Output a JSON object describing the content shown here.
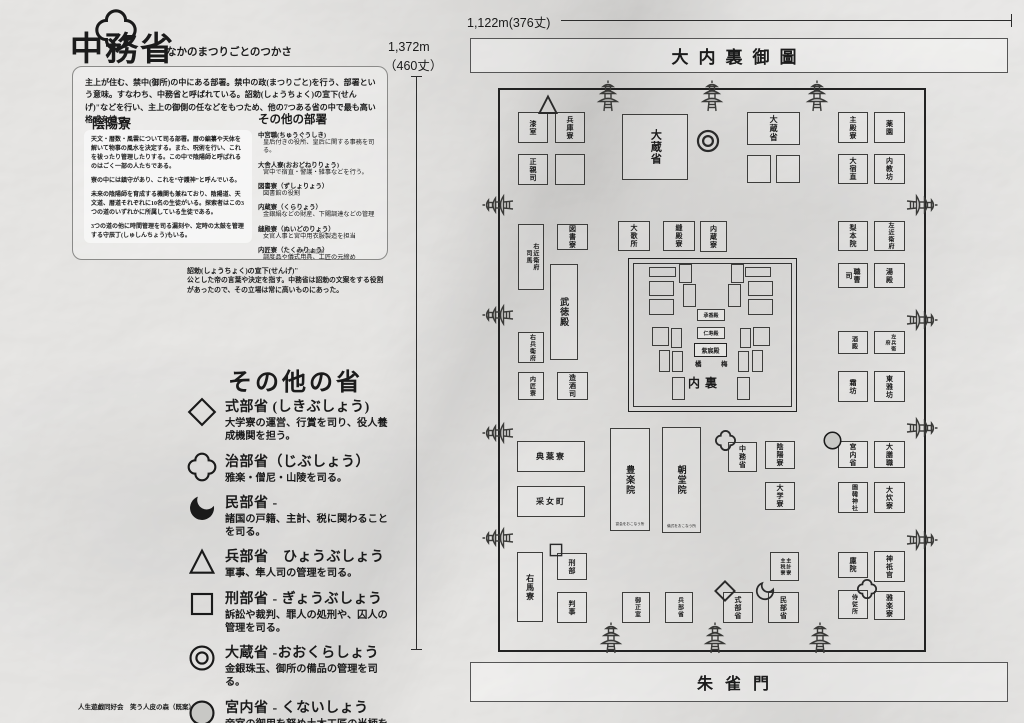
{
  "header": {
    "title": "中務省",
    "title_ruby": "なかのまつりごとのつかさ",
    "intro": "主上が住む、禁中(御所)の中にある部署。禁中の政(まつりごと)を行う、部署という意味。すなわち、中務省と呼ばれている。詔勅(しょうちょく)の宣下(せんげ)\"などを行い、主上の御側の任などをもつため、他の7つある省の中で最も高い格式を持つ。"
  },
  "onmyoryo": {
    "heading": "陰陽寮",
    "paragraphs": [
      "天文・暦数・風雲について司る部署。暦の編纂や天体を解いて物事の風水を決定する。また、呪術を行い、これを祓ったり管理したりする。この中で陰陽師と呼ばれるのはごく一部の人たちである。",
      "寮の中には鎮守があり、これを“守護神”と呼んでいる。",
      "未来の陰陽師を育成する機関も兼ねており、陰陽道、天文道、暦道それぞれに10名の生徒がいる。探索者はこの3つの道のいずれかに所属している生徒である。",
      "3つの道の他に時間管理を司る漏刻や、定時の太鼓を管理する守辰丁(しゅしんちょう)もいる。"
    ]
  },
  "other_departments": {
    "heading": "その他の部署",
    "items": [
      {
        "name": "中宮職(ちゅうぐうしき)",
        "desc": "皇后付きの役所、皇后に関する事務を司る。"
      },
      {
        "name": "大舎人寮(おおどねりりょう)",
        "desc": "宮中で宿直・警護・雑事などを行う。"
      },
      {
        "name": "図書寮（ずしょりょう）",
        "desc": "図書館の役割"
      },
      {
        "name": "内蔵寮（くらりょう）",
        "desc": "金銀絹などの財産、下賜調達などの管理"
      },
      {
        "name": "縫殿寮（ぬいどのりょう）",
        "desc": "女官人事と宮中用衣服製造を担当"
      },
      {
        "name": "内匠寮（たくみりょう）",
        "desc": "調度品や儀式用具、工匠の元締め"
      }
    ],
    "credit": "参考:官職図解"
  },
  "footnote": {
    "title": "詔勅(しょうちょく)の宣下(せんげ)\"",
    "body": "公とした帝の言葉や決定を指す。中務省は詔勅の文案をする役割があったので、その立場は常に高いものにあった。"
  },
  "legend": {
    "heading": "その他の省",
    "items": [
      {
        "symbol": "diamond",
        "name": "式部省 (しきぶしょう)",
        "desc": "大学寮の運営、行賞を司り、役人養成機関を担う。"
      },
      {
        "symbol": "clover",
        "name": "治部省（じぶしょう）",
        "desc": "雅楽・僧尼・山陵を司る。"
      },
      {
        "symbol": "crescent",
        "name": "民部省 -",
        "desc": "諸国の戸籍、主計、税に関わることを司る。"
      },
      {
        "symbol": "triangle",
        "name": "兵部省　ひょうぶしょう",
        "desc": "軍事、隼人司の管理を司る。"
      },
      {
        "symbol": "square",
        "name": "刑部省 - ぎょうぶしょう",
        "desc": "訴訟や裁判、罪人の処刑や、囚人の管理を司る。"
      },
      {
        "symbol": "dcircle",
        "name": "大蔵省 -おおくらしょう",
        "desc": "金銀珠玉、御所の備品の管理を司る。"
      },
      {
        "symbol": "circle",
        "name": "宮内省 - くないしょう",
        "desc": "帝室の御用を努め土木工匠の当柄を司る。"
      }
    ]
  },
  "rulers": {
    "top": "1,122m(376丈)",
    "left_line1": "1,372m",
    "left_line2": "（460丈）"
  },
  "map": {
    "title": "大内裏御圖",
    "south_gate": "朱雀門",
    "buildings": [
      {
        "x": 518,
        "y": 112,
        "w": 30,
        "h": 31,
        "label": "漆室"
      },
      {
        "x": 555,
        "y": 112,
        "w": 30,
        "h": 31,
        "label": "兵庫寮",
        "marker": "triangle",
        "mx": 536,
        "my": 93,
        "ms": 24
      },
      {
        "x": 518,
        "y": 154,
        "w": 30,
        "h": 31,
        "label": "正親司"
      },
      {
        "x": 555,
        "y": 154,
        "w": 30,
        "h": 31,
        "label": ""
      },
      {
        "x": 622,
        "y": 114,
        "w": 66,
        "h": 66,
        "label": "大蔵省",
        "fs": 11,
        "marker": "dcircle",
        "mx": 694,
        "my": 127,
        "ms": 28
      },
      {
        "x": 747,
        "y": 112,
        "w": 53,
        "h": 33,
        "label": "大蔵省",
        "fs": 8
      },
      {
        "x": 747,
        "y": 155,
        "w": 24,
        "h": 28,
        "label": ""
      },
      {
        "x": 776,
        "y": 155,
        "w": 24,
        "h": 28,
        "label": ""
      },
      {
        "x": 838,
        "y": 112,
        "w": 30,
        "h": 31,
        "label": "主殿寮"
      },
      {
        "x": 874,
        "y": 112,
        "w": 31,
        "h": 31,
        "label": "薬園"
      },
      {
        "x": 838,
        "y": 154,
        "w": 30,
        "h": 30,
        "label": "大宿直"
      },
      {
        "x": 874,
        "y": 154,
        "w": 31,
        "h": 30,
        "label": "内教坊"
      },
      {
        "x": 518,
        "y": 224,
        "w": 26,
        "h": 66,
        "label": "右近衛府",
        "label2": "司馬",
        "fs": 6
      },
      {
        "x": 557,
        "y": 224,
        "w": 31,
        "h": 26,
        "label": "図書寮"
      },
      {
        "x": 618,
        "y": 221,
        "w": 32,
        "h": 30,
        "label": "大歌所"
      },
      {
        "x": 663,
        "y": 221,
        "w": 32,
        "h": 30,
        "label": "縫殿寮"
      },
      {
        "x": 700,
        "y": 221,
        "w": 27,
        "h": 31,
        "label": "内蔵寮"
      },
      {
        "x": 838,
        "y": 221,
        "w": 30,
        "h": 30,
        "label": "梨本院"
      },
      {
        "x": 874,
        "y": 221,
        "w": 31,
        "h": 30,
        "label": "左近衛府",
        "fs": 6
      },
      {
        "x": 838,
        "y": 263,
        "w": 30,
        "h": 25,
        "label": "職曹司"
      },
      {
        "x": 874,
        "y": 263,
        "w": 31,
        "h": 25,
        "label": "湯殿"
      },
      {
        "x": 550,
        "y": 264,
        "w": 28,
        "h": 96,
        "label": "武徳殿",
        "fs": 9
      },
      {
        "x": 518,
        "y": 332,
        "w": 26,
        "h": 31,
        "label": "右兵衛府",
        "fs": 6
      },
      {
        "x": 838,
        "y": 331,
        "w": 30,
        "h": 23,
        "label": "酒殿",
        "fs": 6
      },
      {
        "x": 874,
        "y": 331,
        "w": 31,
        "h": 23,
        "label": "左兵衛府",
        "fs": 5
      },
      {
        "x": 518,
        "y": 372,
        "w": 26,
        "h": 28,
        "label": "内匠寮",
        "fs": 6
      },
      {
        "x": 557,
        "y": 372,
        "w": 31,
        "h": 28,
        "label": "造酒司"
      },
      {
        "x": 838,
        "y": 371,
        "w": 30,
        "h": 31,
        "label": "霜坊"
      },
      {
        "x": 874,
        "y": 371,
        "w": 31,
        "h": 31,
        "label": "東雅坊"
      },
      {
        "x": 517,
        "y": 441,
        "w": 68,
        "h": 31,
        "label": "典薬寮",
        "dir": "h",
        "fs": 8
      },
      {
        "x": 517,
        "y": 486,
        "w": 68,
        "h": 31,
        "label": "采女町",
        "dir": "h",
        "fs": 8
      },
      {
        "x": 610,
        "y": 428,
        "w": 40,
        "h": 103,
        "label": "豊楽院",
        "fs": 9,
        "sub": "宴会をおこなう所"
      },
      {
        "x": 662,
        "y": 427,
        "w": 39,
        "h": 106,
        "label": "朝堂院",
        "fs": 9,
        "sub": "儀式をおこなう所"
      },
      {
        "x": 728,
        "y": 442,
        "w": 29,
        "h": 30,
        "label": "中務省",
        "marker": "flower",
        "mx": 714,
        "my": 429,
        "ms": 23
      },
      {
        "x": 765,
        "y": 441,
        "w": 30,
        "h": 28,
        "label": "陰陽寮"
      },
      {
        "x": 765,
        "y": 482,
        "w": 30,
        "h": 28,
        "label": "大学寮"
      },
      {
        "x": 838,
        "y": 441,
        "w": 30,
        "h": 27,
        "label": "宮内省",
        "marker": "circle",
        "mx": 821,
        "my": 429,
        "ms": 23
      },
      {
        "x": 874,
        "y": 441,
        "w": 31,
        "h": 27,
        "label": "大膳職"
      },
      {
        "x": 838,
        "y": 482,
        "w": 30,
        "h": 31,
        "label": "園韓神社",
        "fs": 6
      },
      {
        "x": 874,
        "y": 482,
        "w": 31,
        "h": 31,
        "label": "大炊寮"
      },
      {
        "x": 517,
        "y": 552,
        "w": 26,
        "h": 70,
        "label": "右馬寮",
        "fs": 8
      },
      {
        "x": 557,
        "y": 553,
        "w": 30,
        "h": 27,
        "label": "刑部",
        "marker": "square",
        "mx": 547,
        "my": 541,
        "ms": 18
      },
      {
        "x": 557,
        "y": 592,
        "w": 30,
        "h": 31,
        "label": "判事"
      },
      {
        "x": 622,
        "y": 592,
        "w": 28,
        "h": 31,
        "label": "御正室",
        "fs": 6
      },
      {
        "x": 665,
        "y": 592,
        "w": 28,
        "h": 31,
        "label": "兵部省",
        "fs": 6
      },
      {
        "x": 723,
        "y": 592,
        "w": 30,
        "h": 31,
        "label": "式部省",
        "marker": "diamond",
        "mx": 713,
        "my": 579,
        "ms": 24
      },
      {
        "x": 768,
        "y": 592,
        "w": 31,
        "h": 31,
        "label": "民部省",
        "marker": "crescent",
        "mx": 754,
        "my": 580,
        "ms": 22
      },
      {
        "x": 770,
        "y": 552,
        "w": 29,
        "h": 29,
        "label": "主計寮",
        "label2": "主税寮",
        "fs": 5
      },
      {
        "x": 838,
        "y": 552,
        "w": 30,
        "h": 26,
        "label": "廩院"
      },
      {
        "x": 874,
        "y": 551,
        "w": 31,
        "h": 31,
        "label": "神祇官"
      },
      {
        "x": 838,
        "y": 590,
        "w": 30,
        "h": 29,
        "label": "侍従所",
        "fs": 6
      },
      {
        "x": 874,
        "y": 591,
        "w": 31,
        "h": 29,
        "label": "雅楽寮",
        "marker": "clover",
        "mx": 856,
        "my": 578,
        "ms": 22
      }
    ],
    "inner_palace": {
      "rects": [
        [
          649,
          267,
          25,
          8
        ],
        [
          679,
          264,
          11,
          17
        ],
        [
          731,
          264,
          11,
          17
        ],
        [
          745,
          267,
          24,
          8
        ],
        [
          649,
          281,
          23,
          13
        ],
        [
          683,
          284,
          11,
          21
        ],
        [
          728,
          284,
          11,
          21
        ],
        [
          748,
          281,
          23,
          13
        ],
        [
          649,
          299,
          23,
          14
        ],
        [
          748,
          299,
          23,
          14
        ],
        [
          652,
          327,
          15,
          17
        ],
        [
          671,
          328,
          9,
          18
        ],
        [
          740,
          328,
          9,
          18
        ],
        [
          753,
          327,
          15,
          17
        ],
        [
          659,
          350,
          9,
          20
        ],
        [
          672,
          351,
          9,
          19
        ],
        [
          738,
          351,
          9,
          19
        ],
        [
          752,
          350,
          9,
          20
        ],
        [
          672,
          377,
          11,
          21
        ],
        [
          737,
          377,
          11,
          21
        ]
      ],
      "halls": [
        {
          "x": 697,
          "y": 309,
          "w": 26,
          "h": 10,
          "label": "承香殿",
          "big": false
        },
        {
          "x": 697,
          "y": 327,
          "w": 26,
          "h": 10,
          "label": "仁寿殿",
          "big": false
        },
        {
          "x": 694,
          "y": 343,
          "w": 31,
          "h": 12,
          "label": "紫宸殿",
          "big": true
        }
      ],
      "tachibana": "橘",
      "ume": "梅",
      "name": "内裏"
    },
    "gates": {
      "top_x": [
        596,
        700,
        805
      ],
      "bottom_x": [
        599,
        703,
        808
      ],
      "left_y": [
        189,
        299,
        417,
        522
      ],
      "right_y": [
        189,
        304,
        412,
        524
      ]
    }
  },
  "footer": "人生遊戯同好会　笑う人皮の森（既案）"
}
